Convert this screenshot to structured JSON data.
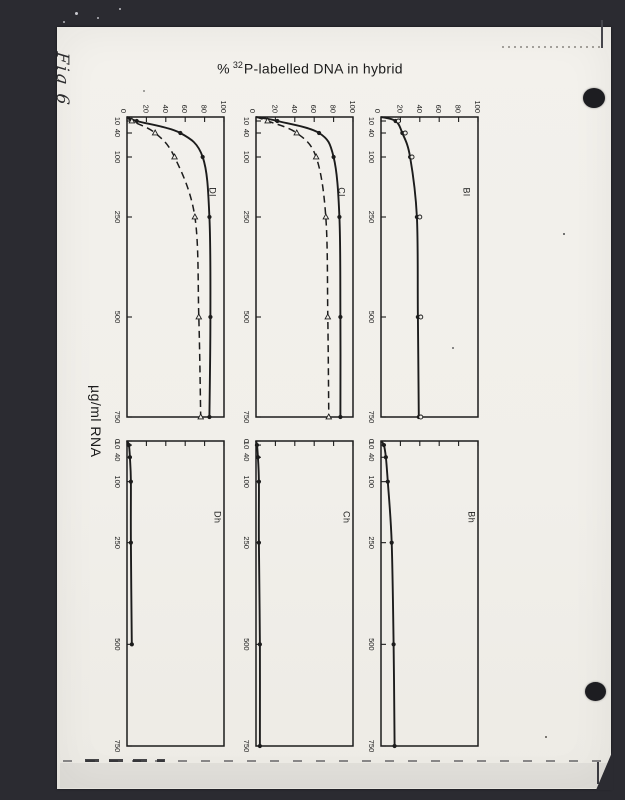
{
  "header": {
    "title_prefix": "%",
    "title_superscript": "32",
    "title_main": "P-labelled DNA in hybrid"
  },
  "annotations": {
    "fig_label": "Fig 6"
  },
  "colors": {
    "backdrop": "#2b2b31",
    "page": "#f1efea",
    "ink": "#1c1c1c",
    "punch_hole": "#1d1d21"
  },
  "chart_data": {
    "type": "line",
    "title": "% 32P-labelled DNA in hybrid",
    "ylabel": "% 32P-labelled DNA in hybrid",
    "xlabel": "µg/ml RNA",
    "orientation": "rotated-90-clockwise-on-page",
    "grid": false,
    "legend": "none",
    "xlim": [
      0,
      750
    ],
    "ylim": [
      0,
      100
    ],
    "x_ticks": [
      "0",
      "10",
      "40",
      "100",
      "250",
      "500",
      "750"
    ],
    "y_ticks": [
      "0",
      "20",
      "40",
      "60",
      "80",
      "100"
    ],
    "panels": [
      {
        "label": "Dl",
        "series": [
          {
            "name": "solid-curve",
            "line": "solid",
            "marker": "filled-circle",
            "points": [
              [
                0,
                0
              ],
              [
                10,
                10
              ],
              [
                40,
                55
              ],
              [
                100,
                78
              ],
              [
                250,
                85
              ],
              [
                500,
                86
              ],
              [
                750,
                85
              ]
            ]
          },
          {
            "name": "dashed-curve",
            "line": "dashed",
            "marker": "open-triangle",
            "points": [
              [
                0,
                0
              ],
              [
                10,
                5
              ],
              [
                40,
                29
              ],
              [
                100,
                49
              ],
              [
                250,
                70
              ],
              [
                500,
                74
              ],
              [
                750,
                76
              ]
            ]
          }
        ]
      },
      {
        "label": "Cl",
        "series": [
          {
            "name": "solid-curve",
            "line": "solid",
            "marker": "filled-circle",
            "points": [
              [
                0,
                0
              ],
              [
                10,
                22
              ],
              [
                40,
                65
              ],
              [
                100,
                80
              ],
              [
                250,
                86
              ],
              [
                500,
                87
              ],
              [
                750,
                87
              ]
            ]
          },
          {
            "name": "dashed-curve",
            "line": "dashed",
            "marker": "open-triangle",
            "points": [
              [
                0,
                0
              ],
              [
                10,
                12
              ],
              [
                40,
                42
              ],
              [
                100,
                62
              ],
              [
                250,
                72
              ],
              [
                500,
                74
              ],
              [
                750,
                75
              ]
            ]
          }
        ]
      },
      {
        "label": "Bl",
        "series": [
          {
            "name": "solid-curve",
            "line": "solid",
            "marker": "filled-circle",
            "points": [
              [
                0,
                0
              ],
              [
                10,
                15
              ],
              [
                40,
                22
              ],
              [
                100,
                30
              ],
              [
                250,
                37
              ],
              [
                500,
                38
              ],
              [
                750,
                39
              ]
            ]
          },
          {
            "name": "open-symbols",
            "line": "none",
            "marker": "open-circle",
            "points": [
              [
                10,
                18
              ],
              [
                40,
                25
              ],
              [
                100,
                32
              ],
              [
                250,
                40
              ],
              [
                500,
                41
              ],
              [
                750,
                41
              ]
            ]
          }
        ]
      },
      {
        "label": "Dh",
        "series": [
          {
            "name": "solid-curve",
            "line": "solid",
            "marker": "filled-circle",
            "points": [
              [
                0,
                0
              ],
              [
                10,
                2
              ],
              [
                40,
                3
              ],
              [
                100,
                4
              ],
              [
                250,
                4
              ],
              [
                500,
                5
              ]
            ]
          }
        ]
      },
      {
        "label": "Ch",
        "series": [
          {
            "name": "solid-curve",
            "line": "solid",
            "marker": "filled-circle",
            "points": [
              [
                0,
                0
              ],
              [
                10,
                1
              ],
              [
                40,
                2
              ],
              [
                100,
                3
              ],
              [
                250,
                3
              ],
              [
                500,
                4
              ],
              [
                750,
                4
              ]
            ]
          }
        ]
      },
      {
        "label": "Bh",
        "series": [
          {
            "name": "solid-curve",
            "line": "solid",
            "marker": "filled-circle",
            "points": [
              [
                0,
                0
              ],
              [
                10,
                3
              ],
              [
                40,
                5
              ],
              [
                100,
                7
              ],
              [
                250,
                11
              ],
              [
                500,
                13
              ],
              [
                750,
                14
              ]
            ]
          }
        ]
      }
    ]
  }
}
